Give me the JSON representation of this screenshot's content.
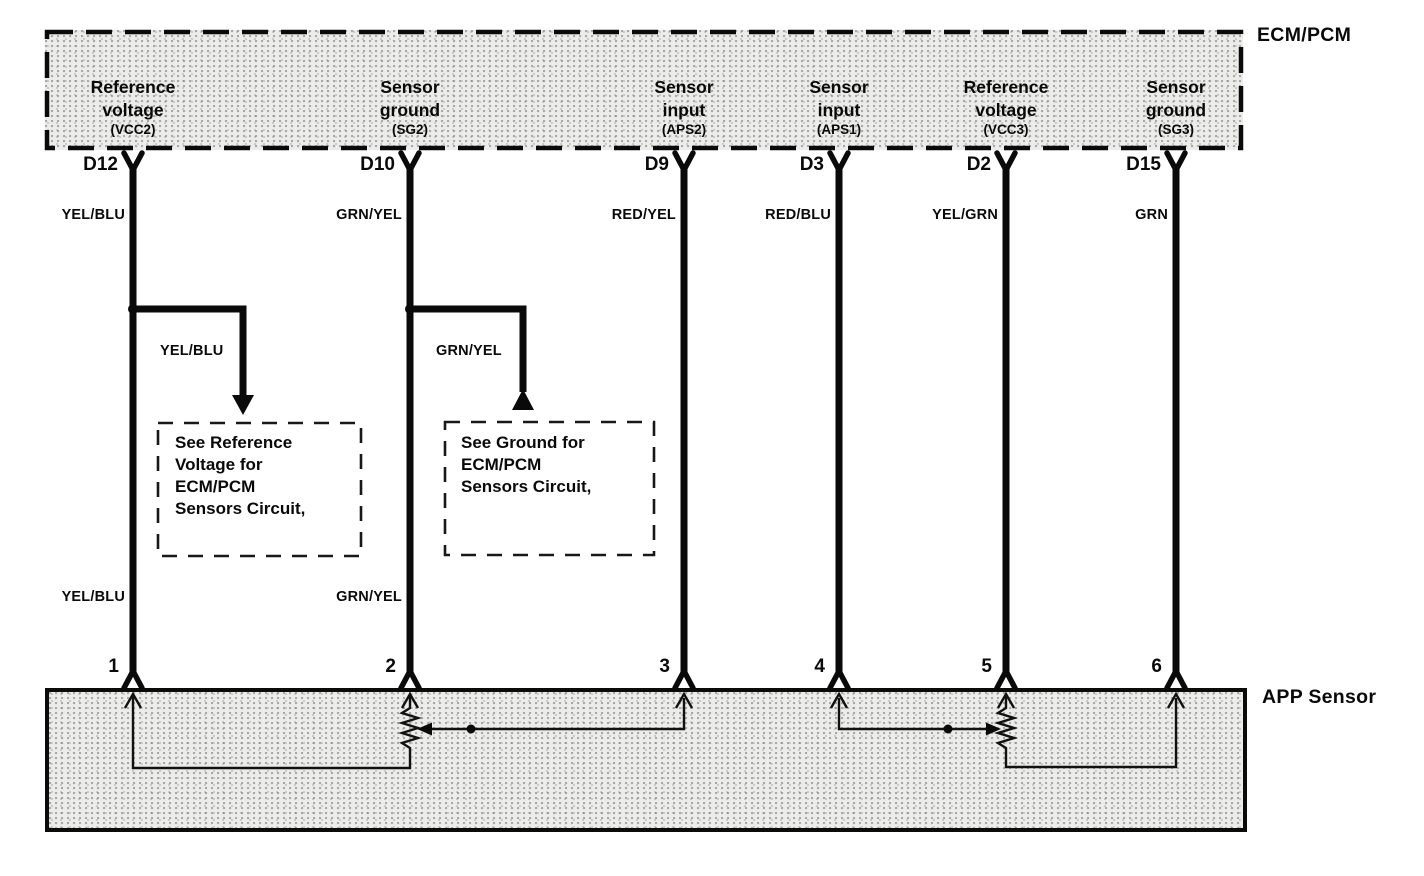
{
  "diagram": {
    "ecm_label": "ECM/PCM",
    "app_label": "APP Sensor",
    "terminals": [
      {
        "line1": "Reference",
        "line2": "voltage",
        "sub": "(VCC2)",
        "pin": "D12",
        "wire_color": "YEL/BLU",
        "pin_number": "1"
      },
      {
        "line1": "Sensor",
        "line2": "ground",
        "sub": "(SG2)",
        "pin": "D10",
        "wire_color": "GRN/YEL",
        "pin_number": "2"
      },
      {
        "line1": "Sensor",
        "line2": "input",
        "sub": "(APS2)",
        "pin": "D9",
        "wire_color": "RED/YEL",
        "pin_number": "3"
      },
      {
        "line1": "Sensor",
        "line2": "input",
        "sub": "(APS1)",
        "pin": "D3",
        "wire_color": "RED/BLU",
        "pin_number": "4"
      },
      {
        "line1": "Reference",
        "line2": "voltage",
        "sub": "(VCC3)",
        "pin": "D2",
        "wire_color": "YEL/GRN",
        "pin_number": "5"
      },
      {
        "line1": "Sensor",
        "line2": "ground",
        "sub": "(SG3)",
        "pin": "D15",
        "wire_color": "GRN",
        "pin_number": "6"
      }
    ],
    "mid_wire_labels": [
      "YEL/BLU",
      "GRN/YEL"
    ],
    "lower_wire_labels": [
      "YEL/BLU",
      "GRN/YEL"
    ],
    "callout_left_lines": [
      "See Reference",
      "Voltage for",
      "ECM/PCM",
      "Sensors Circuit,"
    ],
    "callout_right_lines": [
      "See Ground for",
      "ECM/PCM",
      "Sensors Circuit,"
    ],
    "line_color": "#0a0a0a",
    "box_fill": "#ececea"
  }
}
